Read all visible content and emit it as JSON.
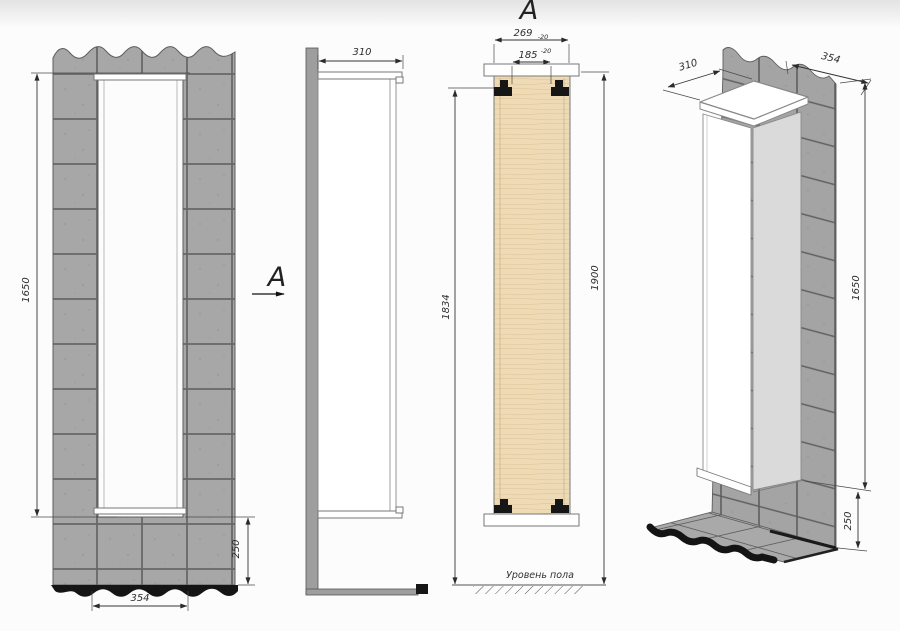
{
  "page": {
    "background": "#fcfcfc",
    "header_band": "#e5e5e5"
  },
  "view_direction_label": "A",
  "section_label": "A",
  "front_view": {
    "dim_height": "1650",
    "dim_plinth_height": "250",
    "dim_opening_width": "354"
  },
  "side_view": {
    "dim_depth": "310"
  },
  "section_view": {
    "dim_outer_width": "269",
    "dim_outer_width_tolerance": "-20",
    "dim_inner_width": "185",
    "dim_inner_width_tolerance": "-20",
    "dim_bracket_height": "1834",
    "dim_overall_height": "1900",
    "floor_level_label": "Уровень пола"
  },
  "iso_view": {
    "dim_depth": "310",
    "dim_width": "354",
    "dim_height": "1650",
    "dim_floor_gap": "250"
  },
  "colors": {
    "tile": "#a7a7a7",
    "tile_joint": "#676767",
    "plinth": "#151515",
    "panel_wood": "#eedbb6",
    "cabinet_face": "#ffffff",
    "cabinet_side": "#dadada",
    "dimension_line": "#333333"
  }
}
